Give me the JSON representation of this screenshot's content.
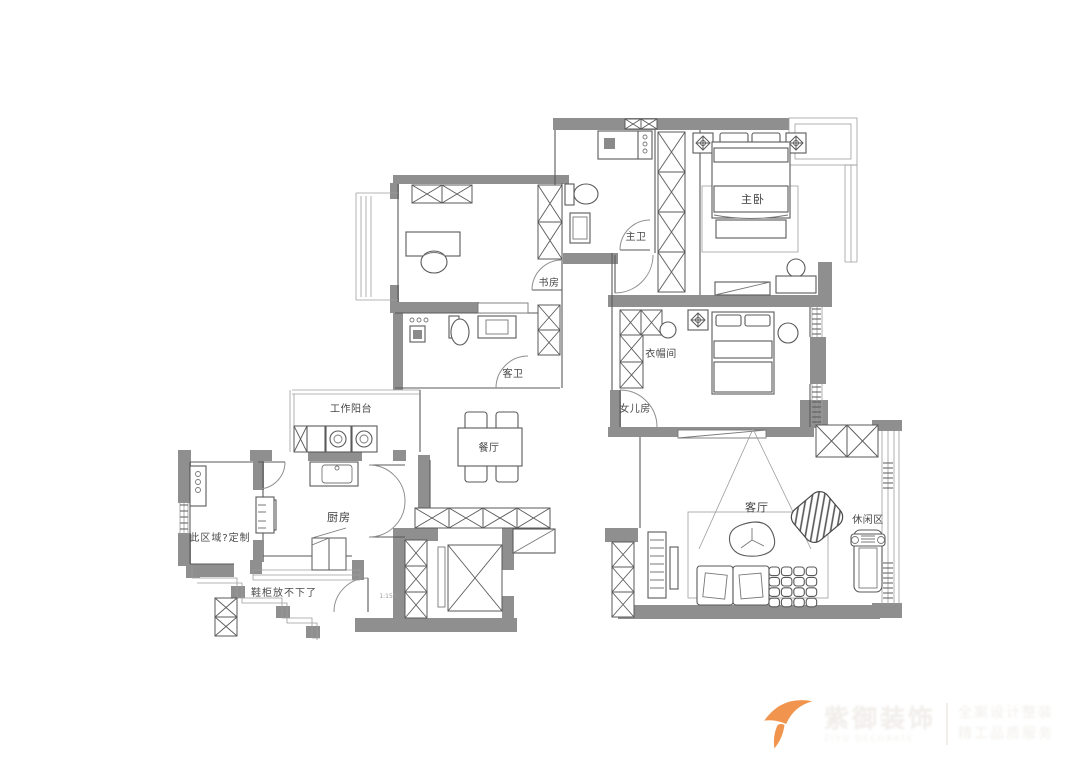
{
  "plan": {
    "rooms": {
      "master_bedroom": "主卧",
      "master_bath": "主卫",
      "study": "书房",
      "guest_bath": "客卫",
      "cloakroom": "衣帽间",
      "daughter_room": "女儿房",
      "dining": "餐厅",
      "living": "客厅",
      "leisure": "休闲区",
      "work_balcony": "工作阳台",
      "kitchen": "厨房"
    },
    "notes": {
      "custom_area": "此区域?定制",
      "shoe_cabinet": "鞋柜放不下了",
      "scale": "1:150"
    },
    "colors": {
      "wall": "#8f8f8f",
      "line": "#5a5a5a"
    }
  },
  "watermark": {
    "brand": "紫御装饰",
    "brand_sub": "ZIYU DECORATE",
    "tagline1": "全案设计整装",
    "tagline2": "精工品质服务",
    "accent": "#f0944e"
  }
}
